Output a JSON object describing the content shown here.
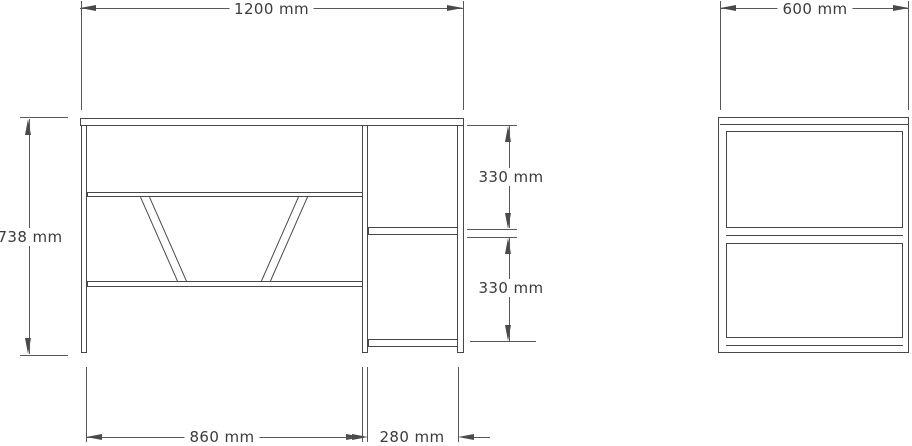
{
  "drawing": {
    "type": "furniture technical drawing (desk, front and side orthographic views)",
    "front_view": {
      "overall_width_label": "1200 mm",
      "overall_height_label": "738 mm",
      "right_upper_compartment_label": "330 mm",
      "right_lower_compartment_label": "330 mm",
      "left_compartment_width_label": "860 mm",
      "right_compartment_width_label": "280 mm"
    },
    "side_view": {
      "depth_label": "600 mm"
    },
    "colors": {
      "background": "#ffffff",
      "outline": "#474747",
      "dimension_line": "#585858",
      "text": "#3b3b3b"
    }
  }
}
